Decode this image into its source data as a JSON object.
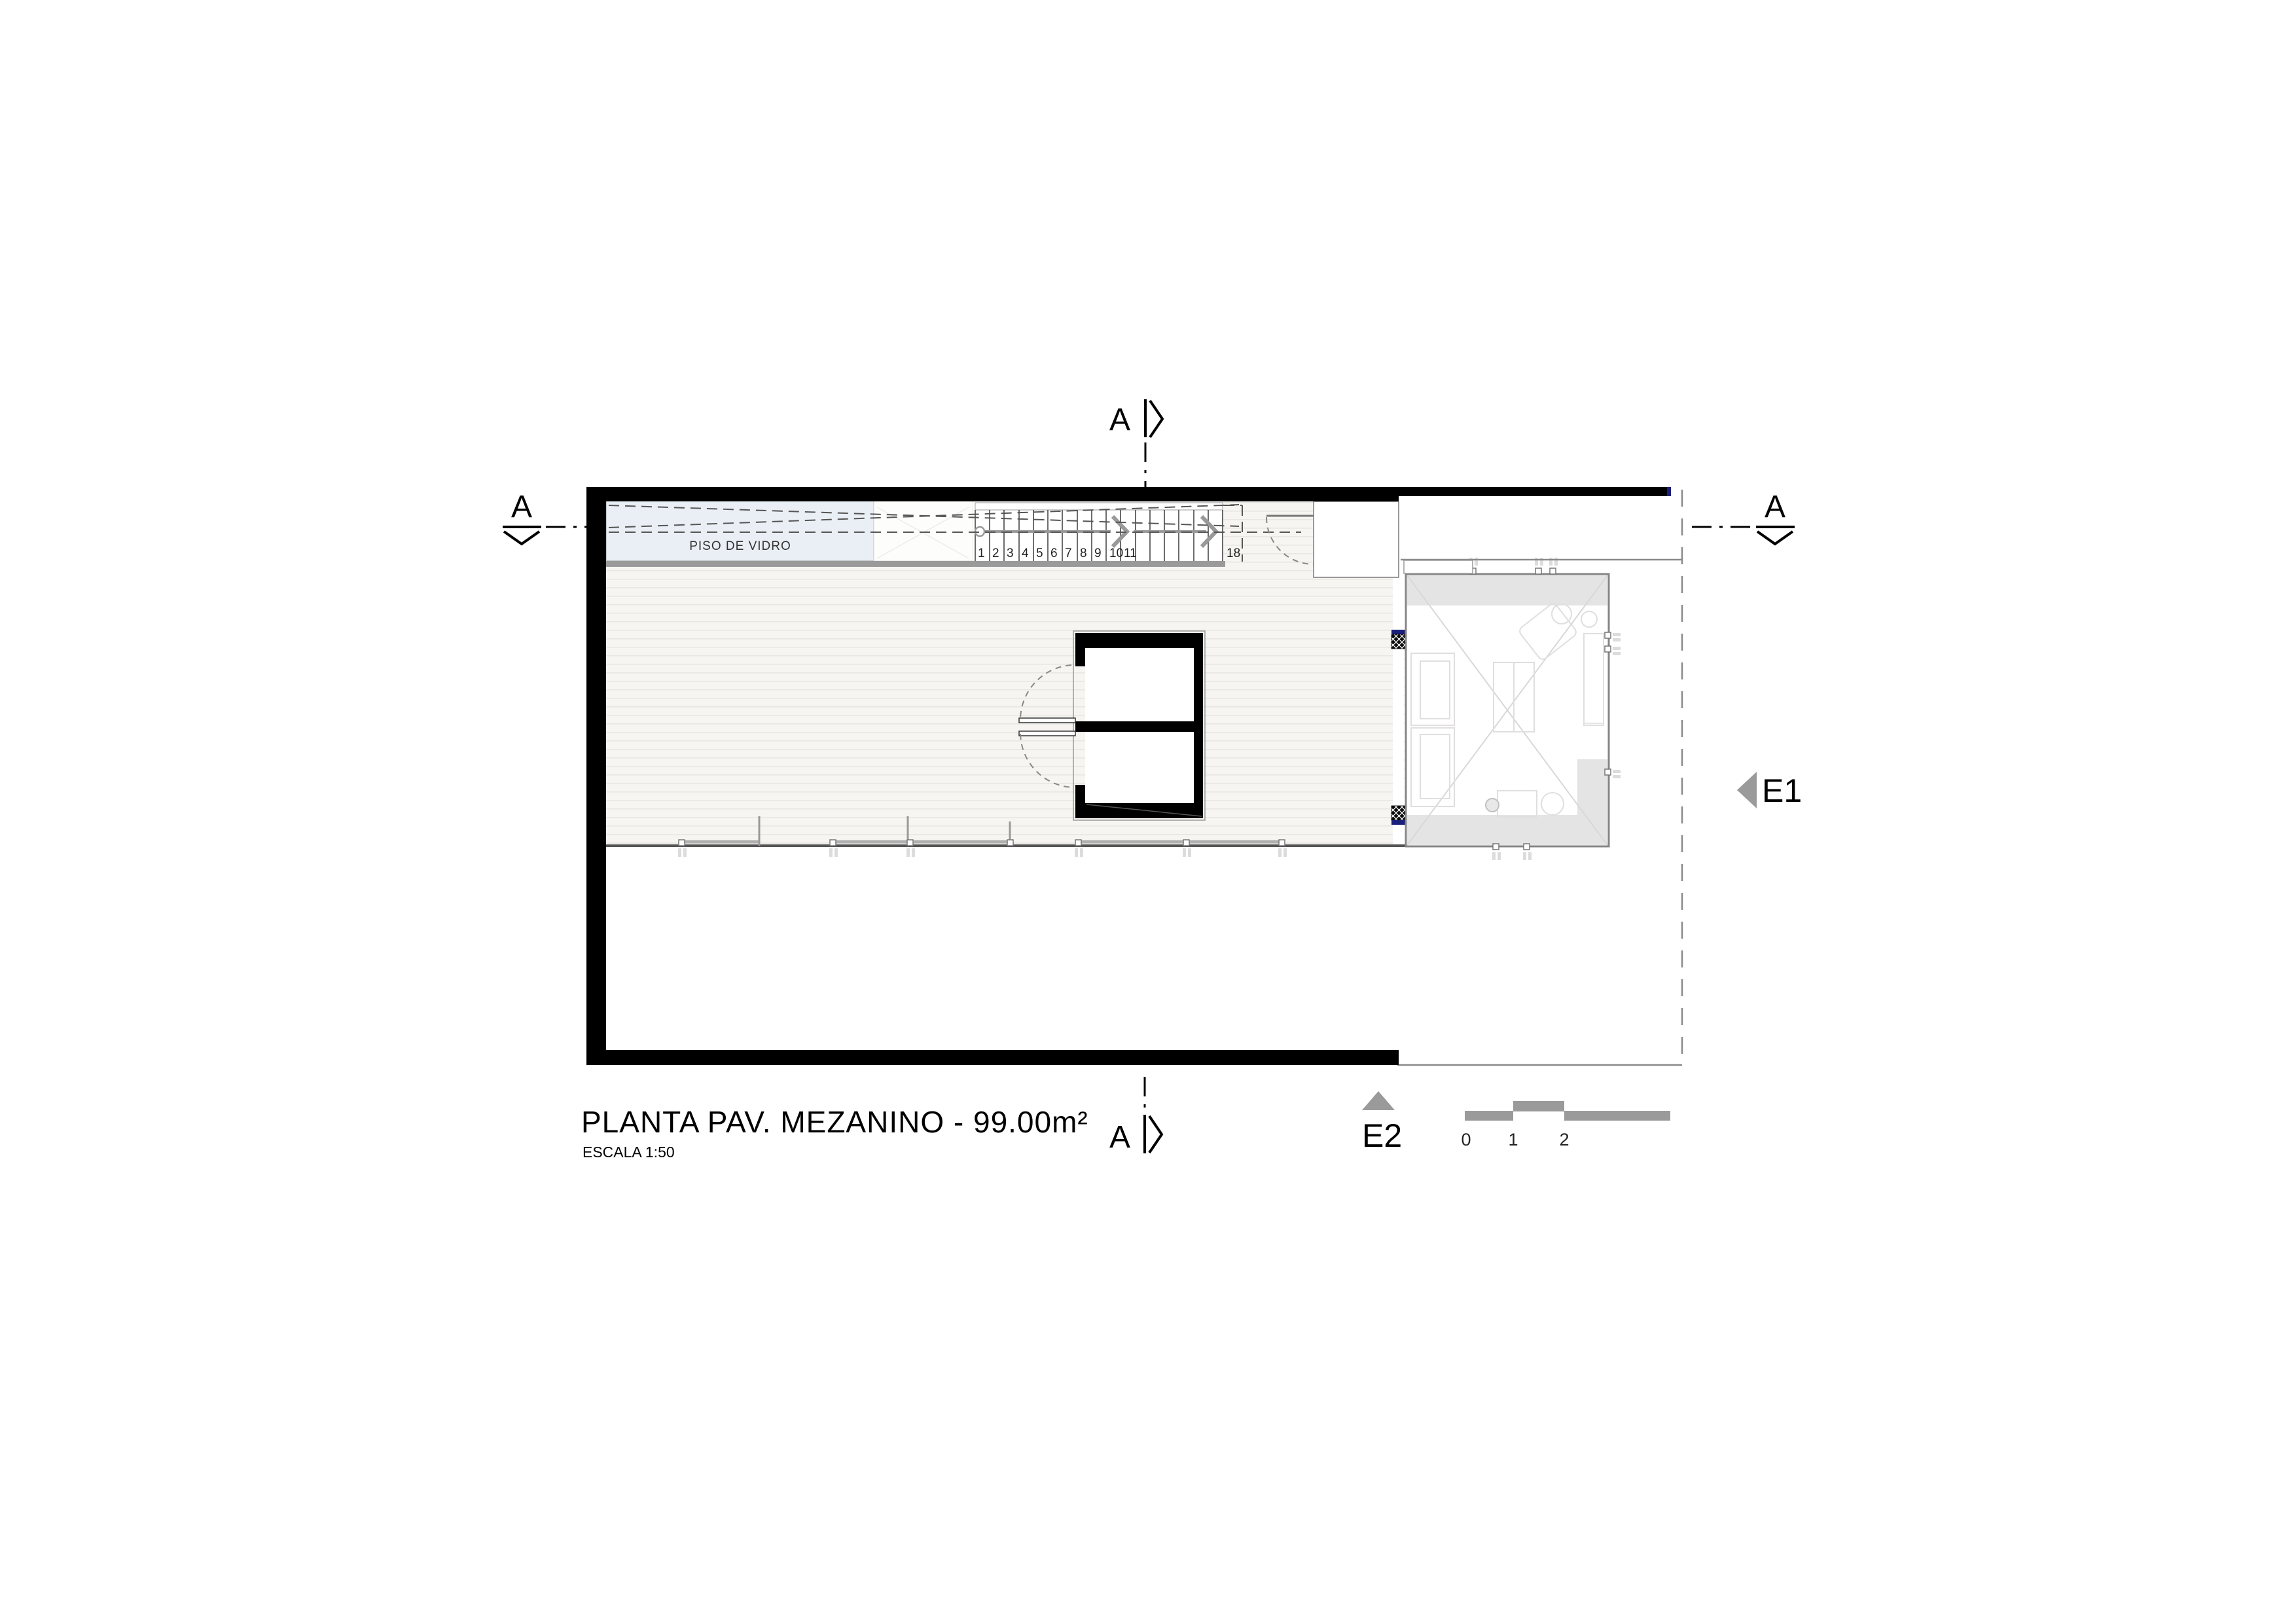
{
  "title": {
    "main": "PLANTA PAV. MEZANINO - 99.00m²",
    "scale": "ESCALA 1:50"
  },
  "plan": {
    "glass_floor_label": "PISO DE VIDRO"
  },
  "stair": {
    "treads": [
      "1",
      "2",
      "3",
      "4",
      "5",
      "6",
      "7",
      "8",
      "9",
      "10",
      "11"
    ],
    "last_tread": "18"
  },
  "section_markers": {
    "top": "A",
    "bottom": "A",
    "left": "A",
    "right": "A"
  },
  "elevation_markers": {
    "e1": "E1",
    "e2": "E2"
  },
  "scale_bar": {
    "ticks": [
      "0",
      "1",
      "2"
    ]
  },
  "colors": {
    "wall": "#000000",
    "accent_navy": "#1b1f7c",
    "marker_gray": "#9a9a9a",
    "glass_floor_fill": "#e9eff5",
    "void_gray": "#e4e4e4",
    "wood_floor": "#f6f5f1"
  }
}
